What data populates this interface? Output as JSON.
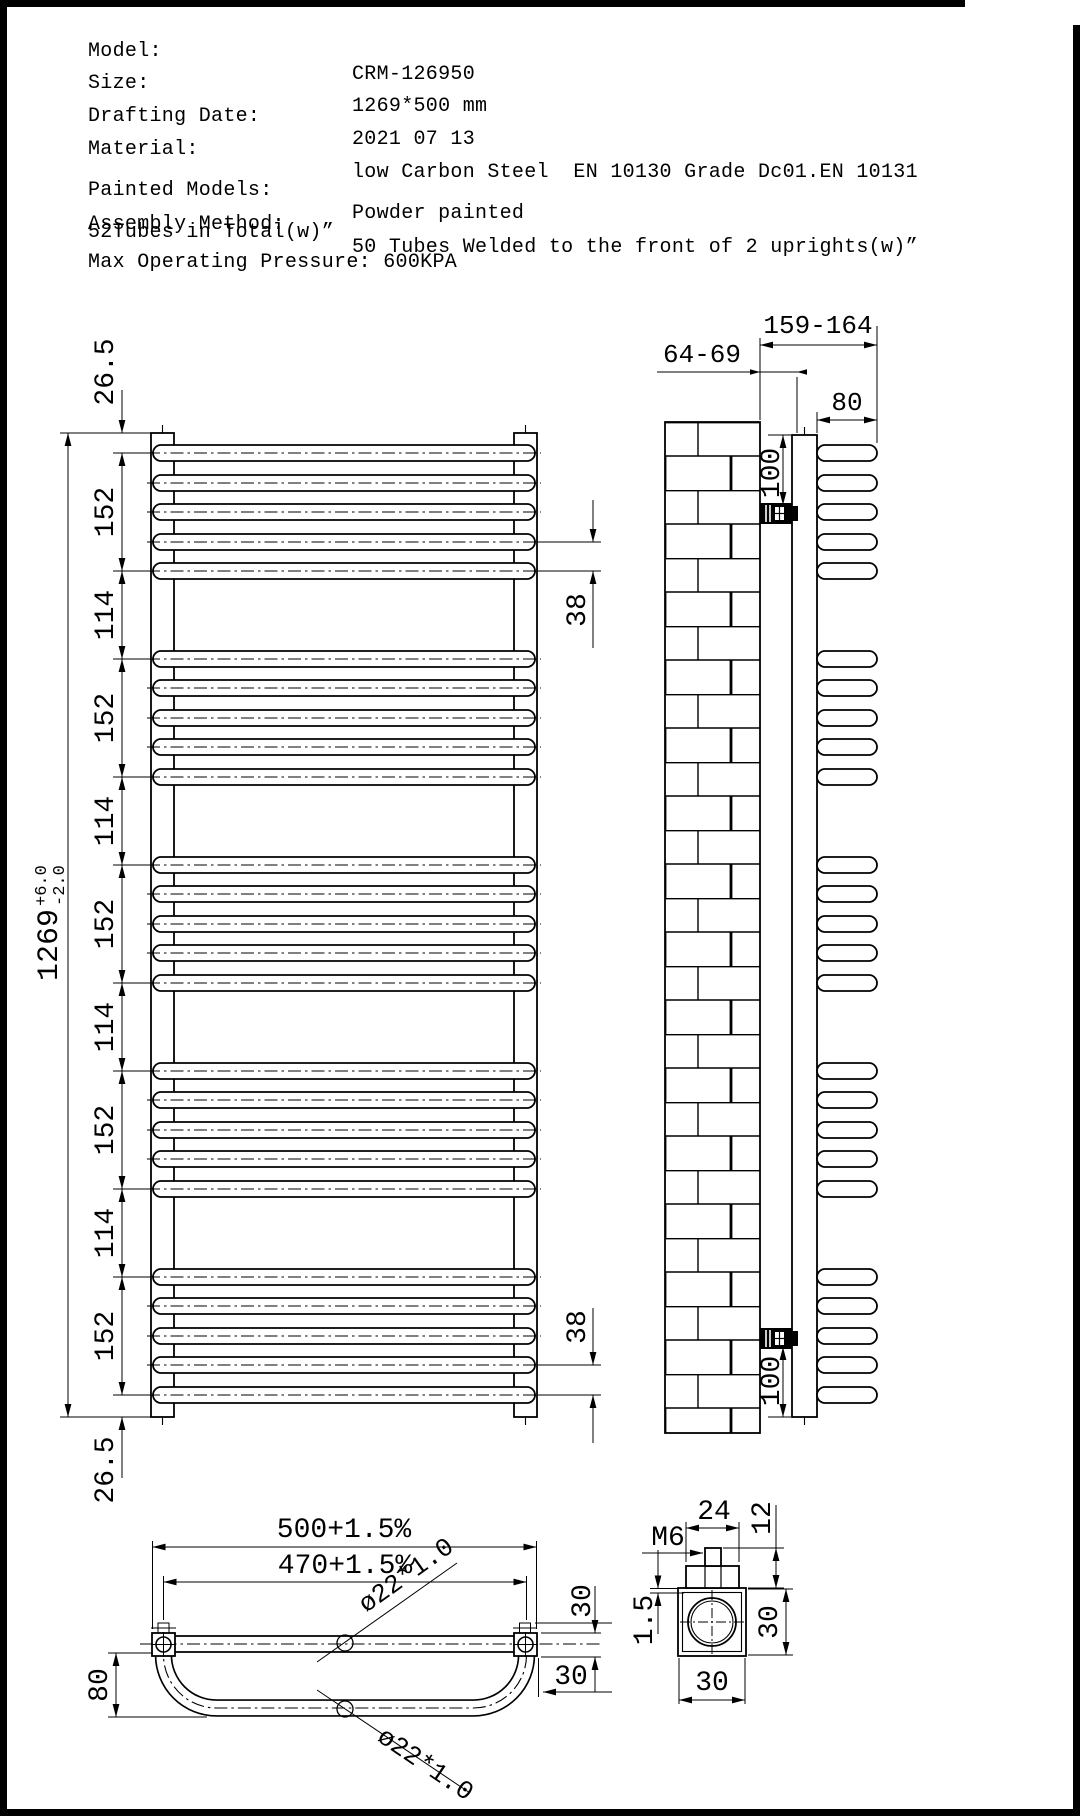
{
  "header": {
    "rows": [
      {
        "label": "Model:",
        "value": "CRM-126950"
      },
      {
        "label": "Size:",
        "value": "1269*500 mm"
      },
      {
        "label": "Drafting Date:",
        "value": "2021 07 13"
      },
      {
        "label": "Material:",
        "value": "low Carbon Steel  EN 10130 Grade Dc01.EN 10131"
      },
      {
        "label": "Painted Models:",
        "value": "Powder painted"
      },
      {
        "label": "Assembly Method:",
        "value": "50 Tubes Welded to the front of 2 uprights(w)”"
      }
    ],
    "note": "52Tubes in Total(w)”",
    "pressure": "Max Operating Pressure: 600KPA"
  },
  "front_view": {
    "dim_overall": {
      "value": "1269",
      "tol_plus": "+6.0",
      "tol_minus": "-2.0"
    },
    "dim_chain": [
      "26.5",
      "152",
      "114",
      "152",
      "114",
      "152",
      "114",
      "152",
      "114",
      "152",
      "26.5"
    ],
    "dim_tube_gap_top": "38",
    "dim_tube_gap_bottom": "38"
  },
  "side_view": {
    "dim_wall_to_front": "159-164",
    "dim_wall_to_upright": "64-69",
    "dim_tube_depth": "80",
    "dim_bracket_top": "100",
    "dim_bracket_bottom": "100"
  },
  "bottom_view": {
    "dim_width": "500+1.5%",
    "dim_centers": "470+1.5%",
    "dim_bow_depth": "80",
    "dim_upright_depth": "30",
    "dim_corner_offset": "30",
    "tube_spec_straight": "ø22*1.0",
    "tube_spec_bowed": "ø22*1.0"
  },
  "detail_view": {
    "dim_boss_width": "24",
    "dim_stud_height": "12",
    "thread": "M6",
    "dim_wall_thickness": "1.5",
    "dim_height": "30",
    "dim_width": "30"
  }
}
